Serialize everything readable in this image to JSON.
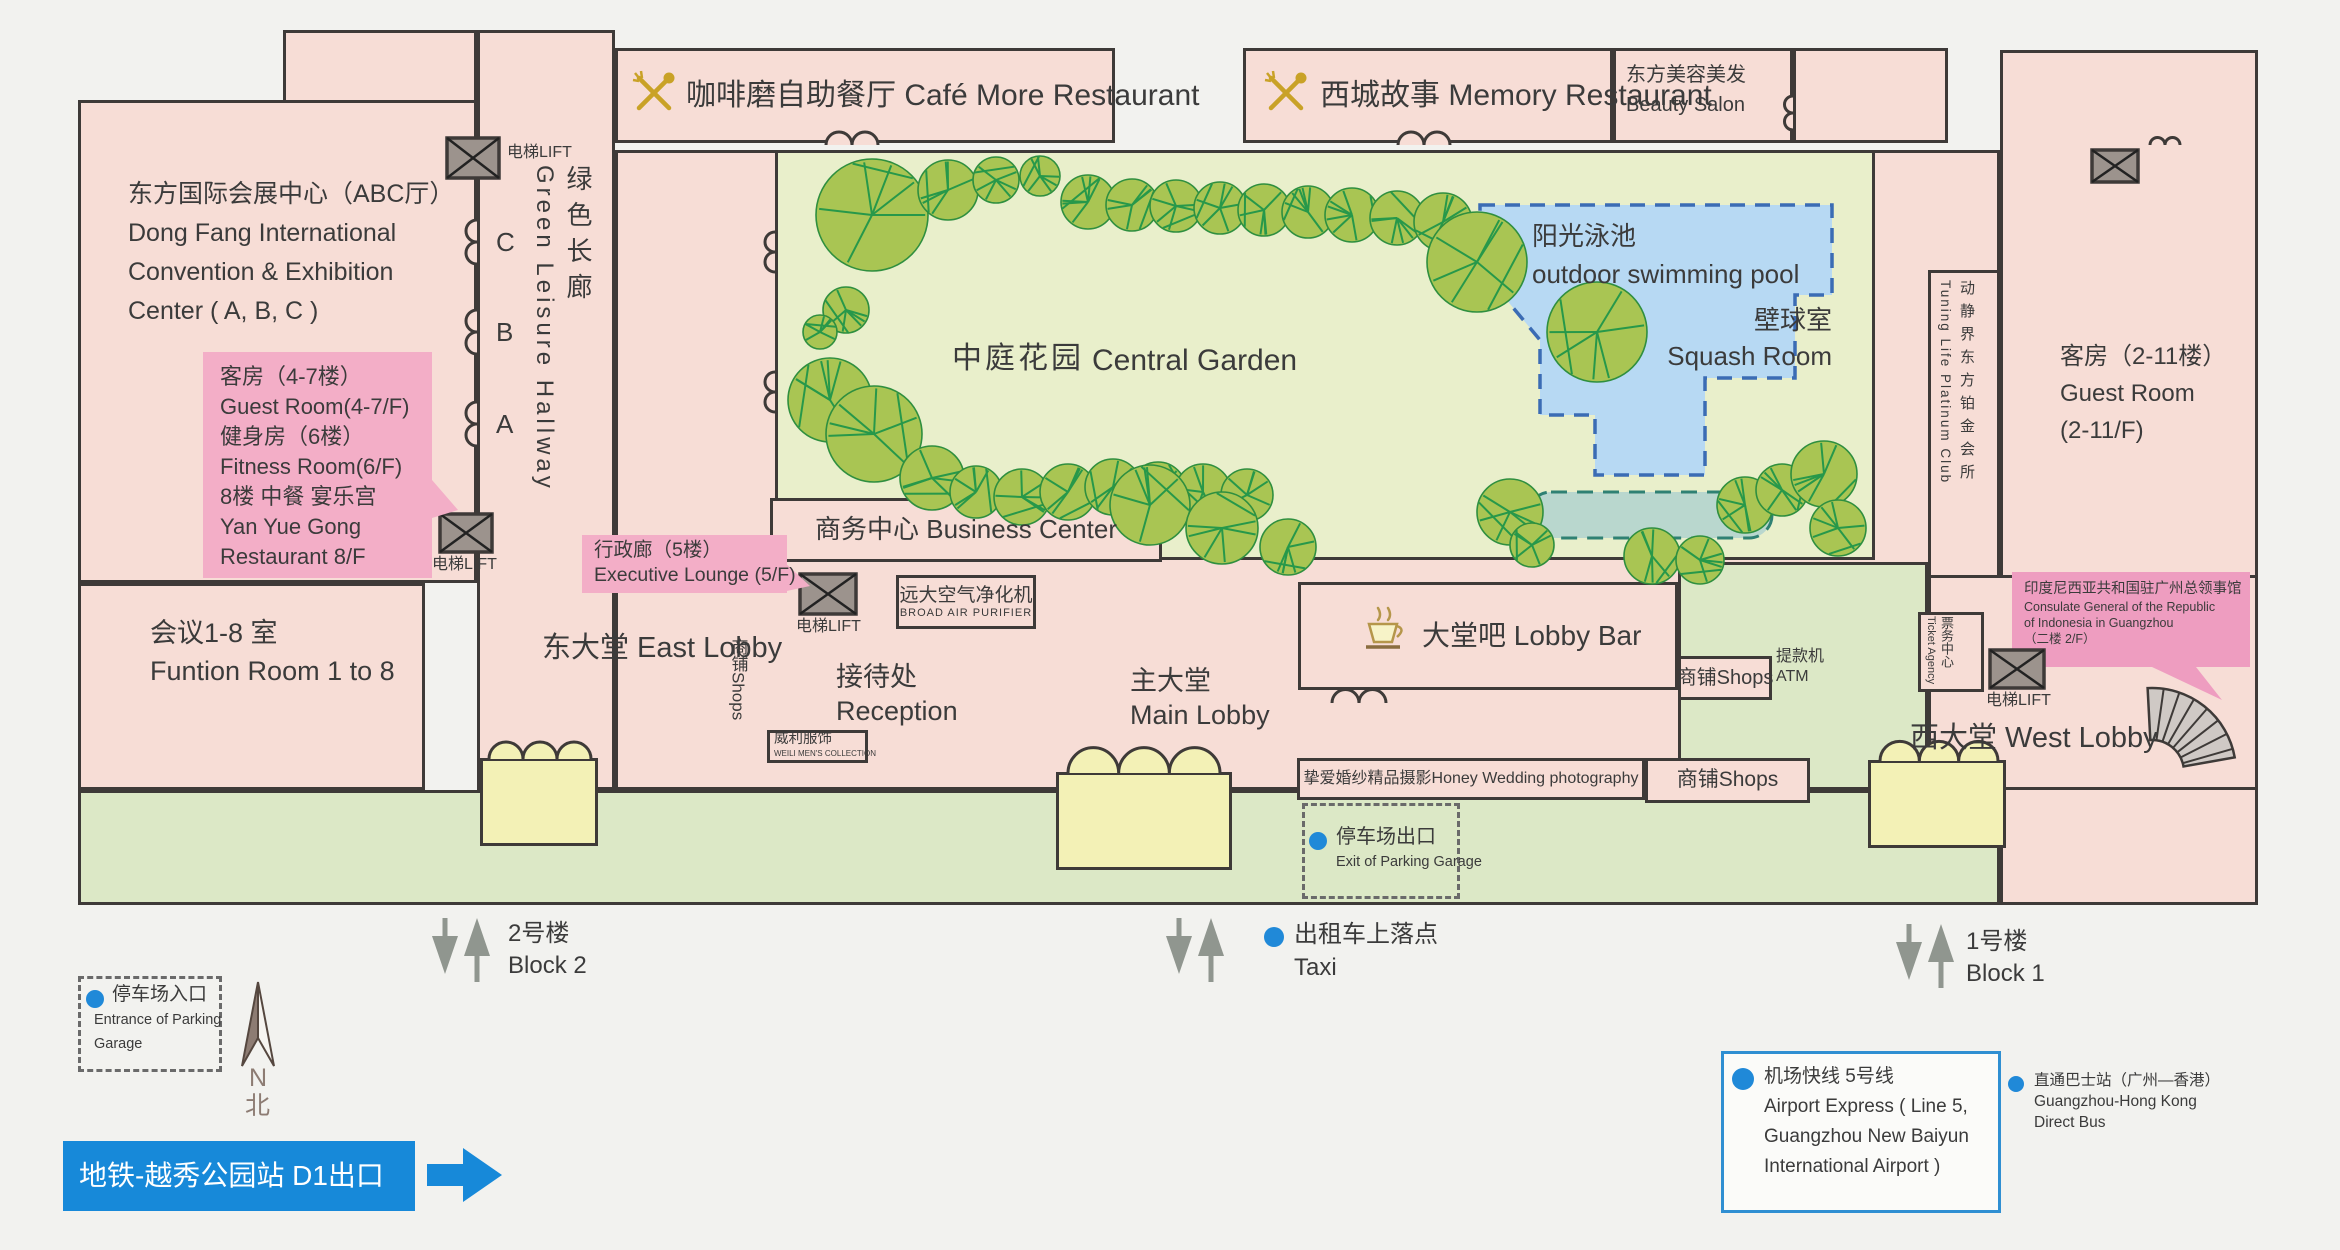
{
  "map": {
    "lift_label": "电梯LIFT",
    "header_bars": {
      "cafe": "咖啡磨自助餐厅 Café More Restaurant",
      "memory": "西城故事 Memory Restaurant",
      "beauty_cn": "东方美容美发",
      "beauty_en": "Beauty Salon"
    },
    "left_wing": {
      "convention": {
        "line1": "东方国际会展中心（ABC厅）",
        "line2": "Dong Fang International",
        "line3": "Convention & Exhibition",
        "line4": "Center ( A, B, C )"
      },
      "guest_callout": {
        "lines": [
          "客房（4-7楼）",
          "Guest Room(4-7/F)",
          "健身房（6楼）",
          "Fitness Room(6/F)",
          "8楼 中餐 宴乐宫",
          "Yan Yue Gong",
          "Restaurant 8/F"
        ]
      },
      "function_room": {
        "cn": "会议1-8 室",
        "en": "Funtion Room 1 to 8"
      },
      "hall_doors": [
        "C",
        "B",
        "A"
      ],
      "hallway_cn": "绿色长廊",
      "hallway_en": "Green Leisure Hallway"
    },
    "garden": {
      "title_cn": "中庭花园",
      "title_en": "Central Garden",
      "pool_cn": "阳光泳池",
      "pool_en": "outdoor swimming pool",
      "squash_cn": "壁球室",
      "squash_en": "Squash Room"
    },
    "center": {
      "business_center": "商务中心 Business Center",
      "executive_line1": "行政廊（5楼）",
      "executive_line2": "Executive Lounge (5/F)",
      "purifier_cn": "远大空气净化机",
      "purifier_en": "BROAD AIR PURIFIER",
      "east_lobby": "东大堂 East Lobby",
      "reception_cn": "接待处",
      "reception_en": "Reception",
      "weili_cn": "威利服饰",
      "weili_en": "WEILI MEN'S COLLECTION",
      "shops_vertical": "商铺Shops",
      "main_lobby_cn": "主大堂",
      "main_lobby_en": "Main Lobby",
      "lobby_bar": "大堂吧 Lobby Bar",
      "shops_mid": "商铺Shops",
      "atm_cn": "提款机",
      "atm_en": "ATM",
      "ticket_cn": "票务中心",
      "ticket_en": "Ticket Agency",
      "west_lobby": "西大堂 West Lobby"
    },
    "right_wing": {
      "tuning_cn": "动静界东方铂金会所",
      "tuning_en": "Tuning Life Platinum Club",
      "guest_line1": "客房（2-11楼）",
      "guest_line2": "Guest Room",
      "guest_line3": "(2-11/F)",
      "consulate": {
        "lines": [
          "印度尼西亚共和国驻广州总领事馆",
          "Consulate General of the Republic",
          "of Indonesia  in Guangzhou",
          "（二楼  2/F）"
        ]
      }
    },
    "bottom_row": {
      "honey": "挚爱婚纱精品摄影Honey Wedding photography",
      "shops": "商铺Shops",
      "parking_exit_cn": "停车场出口",
      "parking_exit_en": "Exit of Parking Garage"
    }
  },
  "outside": {
    "block2_cn": "2号楼",
    "block2_en": "Block 2",
    "taxi_cn": "出租车上落点",
    "taxi_en": "Taxi",
    "block1_cn": "1号楼",
    "block1_en": "Block 1",
    "parking_entrance_cn": "停车场入口",
    "parking_entrance_en1": "Entrance of Parking",
    "parking_entrance_en2": "Garage",
    "north_letter": "N",
    "north_cn": "北",
    "metro": "地铁-越秀公园站 D1出口",
    "airport_express": {
      "lines": [
        "机场快线 5号线",
        "Airport Express ( Line 5,",
        "Guangzhou New Baiyun",
        "International Airport )"
      ]
    },
    "direct_bus": {
      "lines": [
        "直通巴士站（广州—香港）",
        "Guangzhou-Hong Kong",
        "Direct Bus"
      ]
    }
  },
  "colors": {
    "building_pink": "#f7ddd6",
    "callout_pink": "#f3aec7",
    "consulate_pink": "#ee9dc0",
    "garden_green": "#e9efcb",
    "walkway_green": "#dce8c6",
    "tree_green": "#a9c553",
    "pool_blue": "#b7d9f3",
    "pond_teal": "#b9d7ce",
    "canopy_yellow": "#f3f1b6",
    "metro_blue": "#1789d9",
    "dot_blue": "#2089d8",
    "wall": "#3e3a38",
    "gold": "#c9a227"
  }
}
